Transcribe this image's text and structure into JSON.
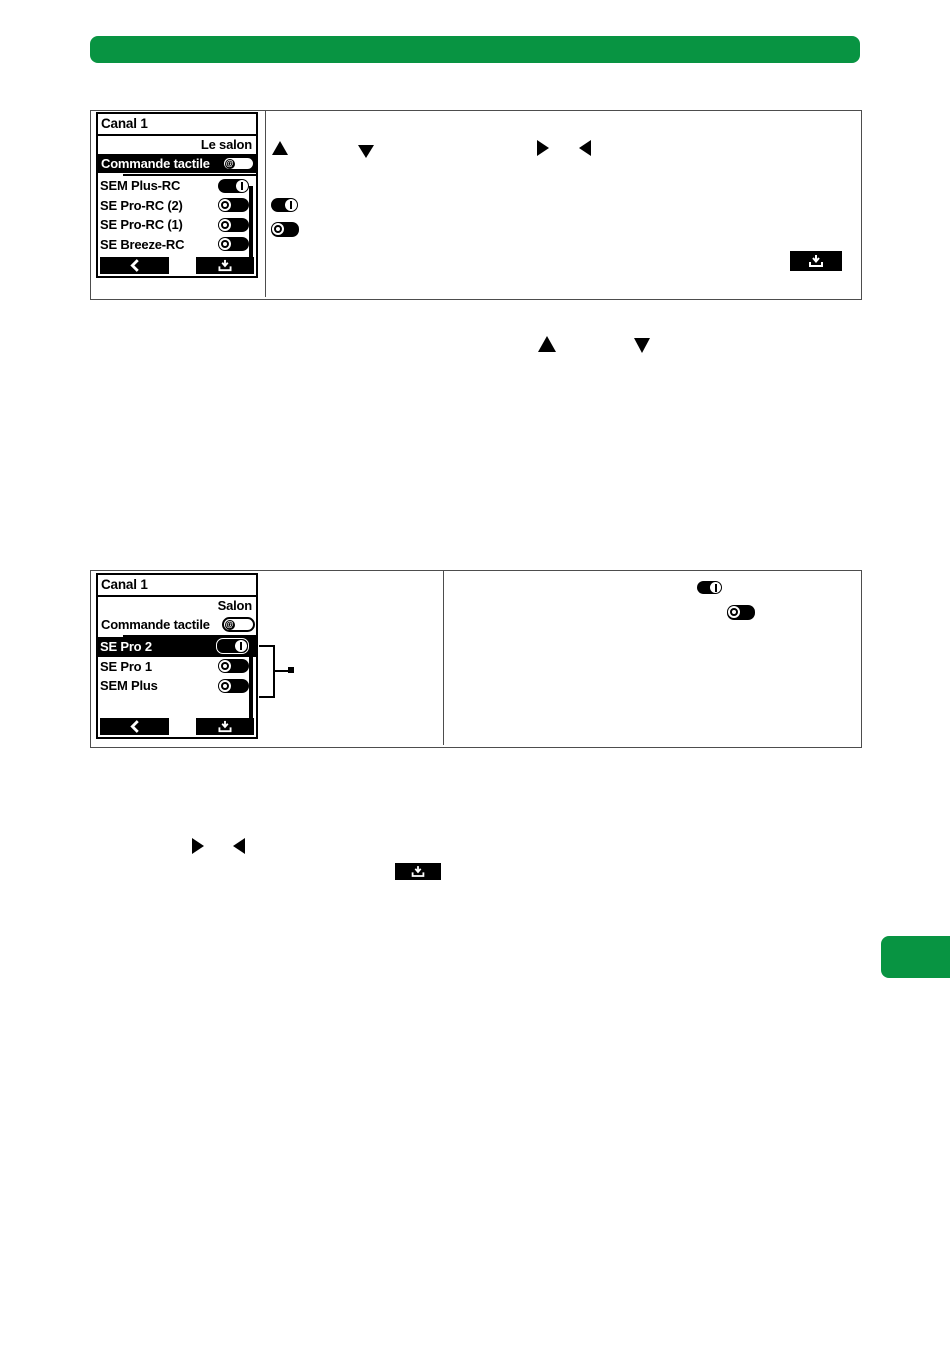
{
  "page": {
    "background": "#ffffff",
    "accent_green": "#089442"
  },
  "header_bar": {
    "type": "green-rounded-bar",
    "color": "#089442",
    "text": ""
  },
  "figure1": {
    "remote_screen": {
      "title": "Canal 1",
      "room_label": "Le salon",
      "touch_row": {
        "label": "Commande tactile",
        "toggle": "touch-pill"
      },
      "devices": [
        {
          "label": "SEM Plus-RC",
          "state": "on"
        },
        {
          "label": "SE Pro-RC (2)",
          "state": "off"
        },
        {
          "label": "SE Pro-RC (1)",
          "state": "off"
        },
        {
          "label": "SE Breeze-RC",
          "state": "off"
        }
      ],
      "nav": {
        "back_icon": "chevron-left-icon",
        "confirm_icon": "save-enter-icon"
      }
    },
    "inline_icons": [
      "arrow-up-icon",
      "arrow-down-icon",
      "arrow-right-icon",
      "arrow-left-icon",
      "toggle-on-icon",
      "toggle-off-icon",
      "save-button-icon"
    ]
  },
  "mid_icons": [
    "arrow-up-icon",
    "arrow-down-icon"
  ],
  "figure2": {
    "remote_screen": {
      "title": "Canal 1",
      "room_label": "Salon",
      "touch_row": {
        "label": "Commande tactile",
        "toggle": "touch-pill"
      },
      "devices": [
        {
          "label": "SE Pro 2",
          "state": "on",
          "selected": true
        },
        {
          "label": "SE Pro 1",
          "state": "off"
        },
        {
          "label": "SEM Plus",
          "state": "off"
        }
      ],
      "nav": {
        "back_icon": "chevron-left-icon",
        "confirm_icon": "save-enter-icon"
      }
    },
    "inline_icons": [
      "toggle-on-icon",
      "toggle-off-icon"
    ],
    "callout": {
      "marker": "bracket-with-dot"
    }
  },
  "footer_icons": [
    "arrow-right-icon",
    "arrow-left-icon",
    "save-button-icon"
  ],
  "side_tab": {
    "type": "green-page-tab",
    "color": "#089442"
  }
}
